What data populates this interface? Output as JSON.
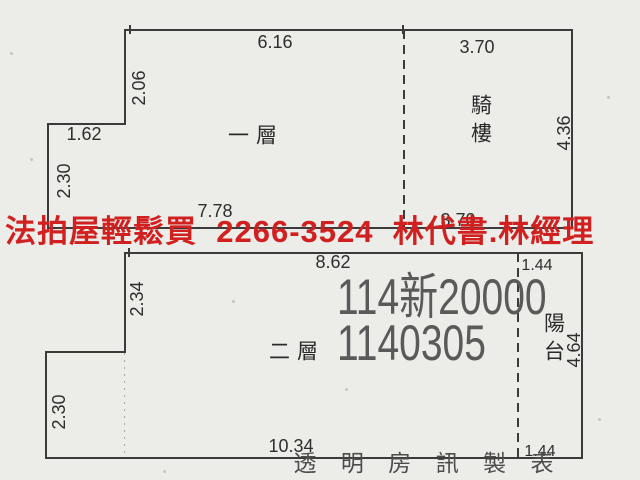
{
  "watermark": {
    "text": "法拍屋輕鬆買  2266-3524  林代書.林經理",
    "color": "#d02020"
  },
  "stamp": {
    "case_number": "114新20000",
    "date_code": "1140305",
    "color": "#5a5a5a"
  },
  "footer": {
    "credit": "透 明 房 訊 製 表"
  },
  "floor_plans": {
    "first_floor": {
      "label": "一層",
      "annex_label": "騎樓",
      "dimensions": {
        "top_width": "6.16",
        "annex_top_width": "3.70",
        "upper_left_height": "2.06",
        "step_width": "1.62",
        "lower_left_height": "2.30",
        "bottom_width": "7.78",
        "annex_bottom_width": "3.70",
        "right_height": "4.36"
      }
    },
    "second_floor": {
      "label": "二層",
      "annex_label": "陽台",
      "dimensions": {
        "top_width": "8.62",
        "annex_top_width": "1.44",
        "upper_left_height": "2.34",
        "lower_left_height": "2.30",
        "bottom_width": "10.34",
        "annex_bottom_width": "1.44",
        "right_height": "4.64"
      }
    }
  }
}
